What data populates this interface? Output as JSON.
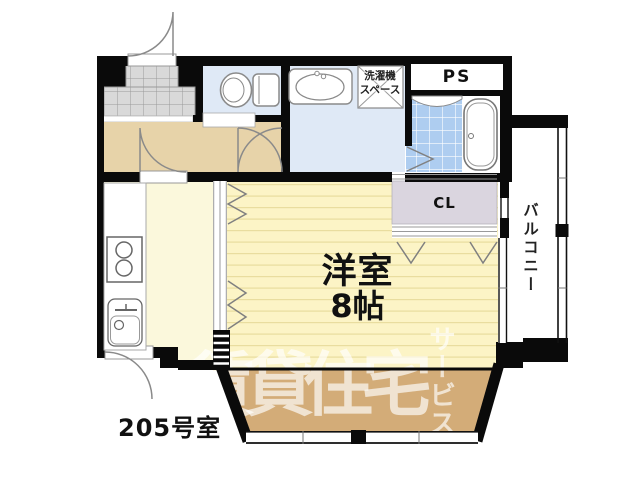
{
  "labels": {
    "pipe_space": "PS",
    "closet": "CL",
    "washer_line1": "洗濯機",
    "washer_line2": "スペース",
    "balcony": "バルコニー",
    "room_name": "洋室",
    "room_size": "8帖",
    "unit": "205号室",
    "watermark_main": "賃貸住宅",
    "watermark_sub": "サービス"
  },
  "colors": {
    "wall": "#0a0a0a",
    "hallway": "#e7d3a9",
    "kitchen": "#fbf8dc",
    "room": "#fcf4c6",
    "room_stripe": "#e9dd9f",
    "wet_floor": "#dfe9f6",
    "bath_tile": "#aecdf0",
    "closet_fill": "#dad5df",
    "genkan_tile": "#d9d9d9",
    "genkan_line": "#9a9a9a",
    "service_balcony": "#d3ac78",
    "fixture_line": "#8a8a8a",
    "watermark": "rgba(255,255,255,0.66)"
  }
}
